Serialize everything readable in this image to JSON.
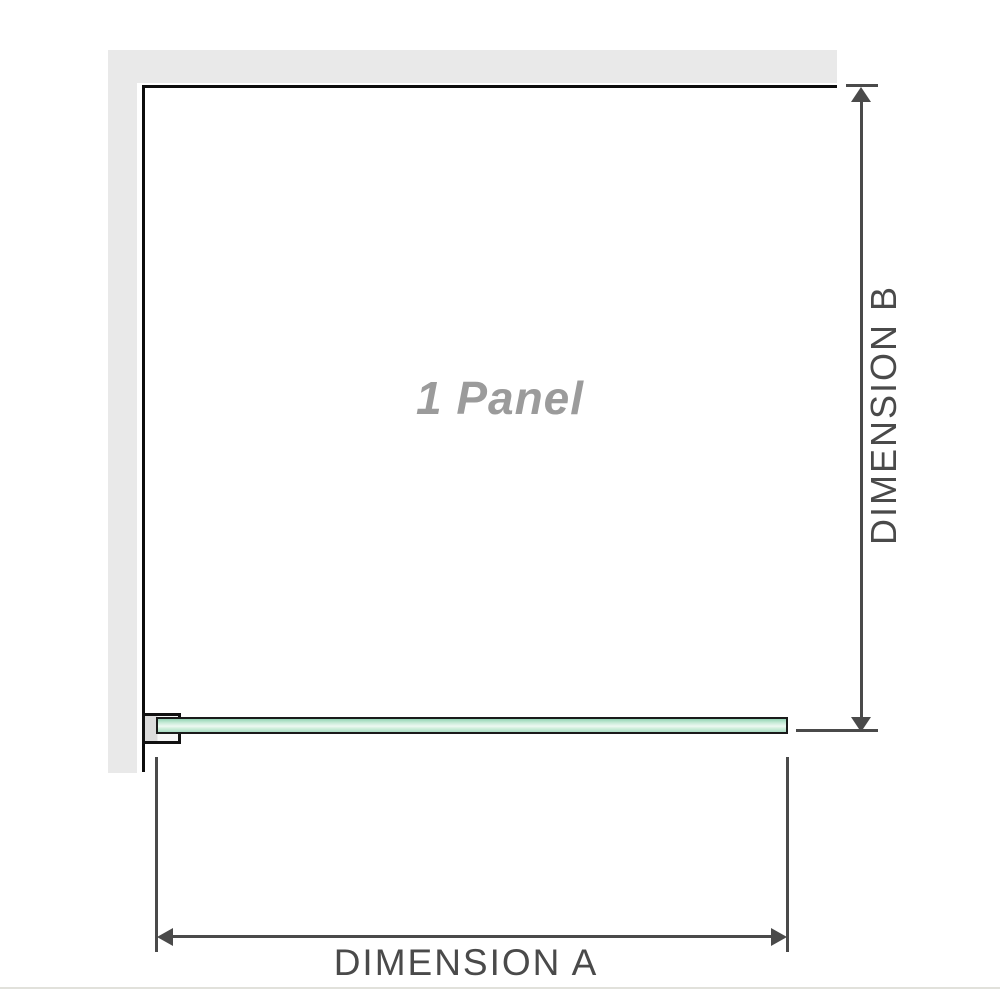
{
  "diagram": {
    "panel_label": "1 Panel",
    "dimension_a_label": "DIMENSION A",
    "dimension_b_label": "DIMENSION B"
  },
  "colors": {
    "background": "#ffffff",
    "wall_gray": "#e9e9e9",
    "outline_black": "#0d0d0d",
    "dimension_gray": "#4a4a4a",
    "panel_text_gray": "#9b9b9b",
    "glass_border": "#1a1a1a",
    "glass_green_dark": "#93d4b4",
    "glass_green_pale": "#eef9f2",
    "glass_green_light": "#a9dcc3",
    "bracket_fill_gray": "#dcdcdc"
  }
}
